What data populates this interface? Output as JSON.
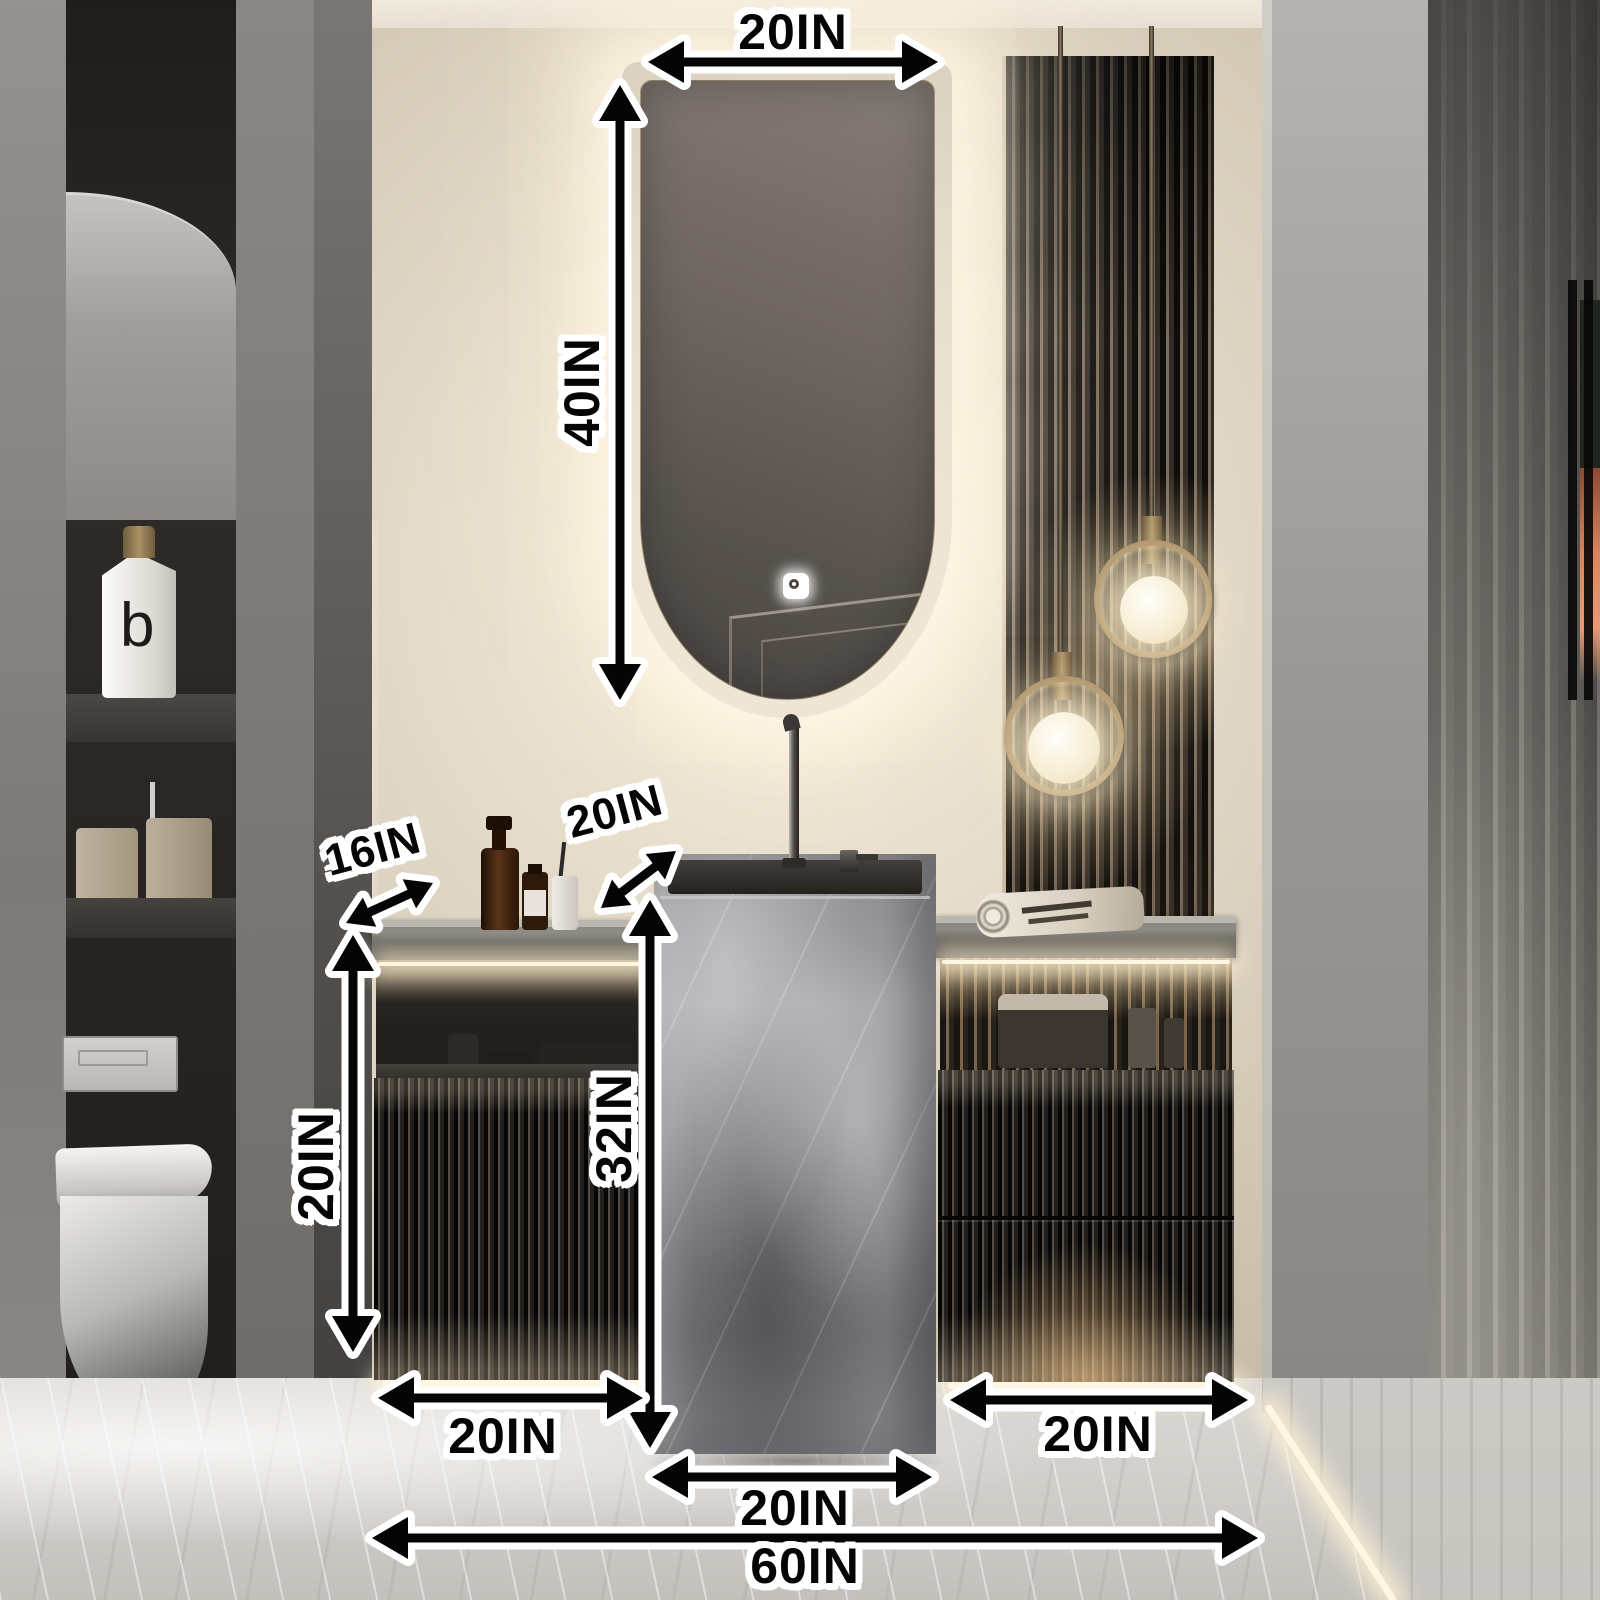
{
  "scene_description": "Modern bathroom vanity photo: backlit capsule mirror, grey marble pedestal basin with tall faucet, two dark fluted cabinets with lit open shelves, wood slat panel with two brass ring globe pendants, wall niche with toiletries and wall-hung toilet at left, marble floor; black dimension arrows overlaid",
  "annotations": {
    "mirror_width": "20IN",
    "mirror_height": "40IN",
    "counter_depth": "16IN",
    "basin_depth": "20IN",
    "basin_height": "32IN",
    "left_cabinet_height": "20IN",
    "left_cabinet_width": "20IN",
    "basin_width": "20IN",
    "right_cabinet_width": "20IN",
    "total_width": "60IN"
  },
  "objects": {
    "niche_bottle_logo": "b"
  },
  "colors": {
    "annotation_text": "#050505",
    "annotation_outline": "#ffffff",
    "wall_beige": "#e6dccb",
    "warm_glow": "#fff3dc",
    "brass": "#a6885e",
    "marble_grey": "#8f8e92",
    "cabinet_dark": "#221f1c",
    "floor": "#d6d3cf",
    "accent_orange": "#d9855f"
  }
}
